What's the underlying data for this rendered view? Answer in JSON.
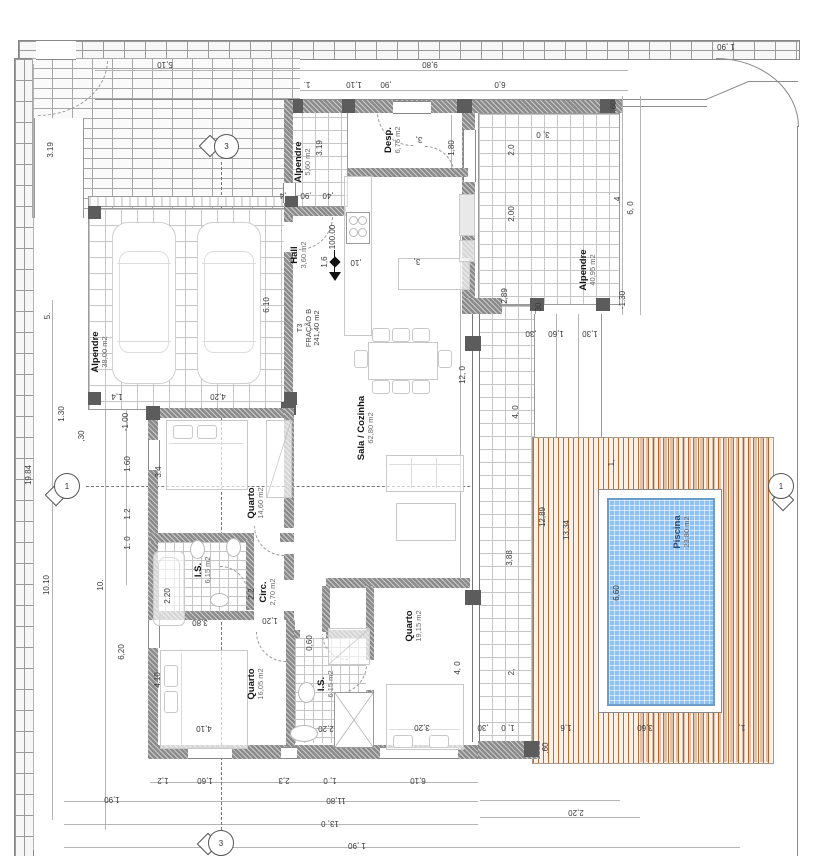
{
  "document": {
    "type": "architectural-floor-plan",
    "language": "pt"
  },
  "unit": {
    "l1": "T3",
    "l2": "FRAÇÃO B",
    "area": "241,40 m2"
  },
  "rooms": [
    {
      "name": "Alpendre",
      "area": "38,00 m2"
    },
    {
      "name": "Alpendre",
      "area": "5,60 m2"
    },
    {
      "name": "Hall",
      "area": "3,60 m2"
    },
    {
      "name": "Desp.",
      "area": "6,75 m2"
    },
    {
      "name": "Sala / Cozinha",
      "area": "62,80 m2"
    },
    {
      "name": "Quarto",
      "area": "14,60 m2"
    },
    {
      "name": "I.S.",
      "area": "6,15 m2"
    },
    {
      "name": "Circ.",
      "area": "2,70 m2"
    },
    {
      "name": "Quarto",
      "area": "16,05 m2"
    },
    {
      "name": "I.S.",
      "area": "6,15 m2"
    },
    {
      "name": "Quarto",
      "area": "19,15 m2"
    },
    {
      "name": "Alpendre",
      "area": "40,95 m2"
    },
    {
      "name": "Piscina",
      "area": "23,80 m2"
    }
  ],
  "level_marker": "100.00",
  "section_markers": {
    "horizontal": "1",
    "vertical": "3"
  },
  "dims": [
    "5,10",
    "9,80",
    "1.",
    "1,10",
    ",90",
    "6,0",
    "1 ,90",
    "3, 0",
    ".60",
    ".4",
    "6, 0",
    "2,0",
    "2,00",
    "2,89",
    "-1.30",
    ",30",
    "1,60",
    "1,30",
    "12,89",
    "13,34",
    "1,",
    "6,60",
    "3,88",
    "4, 0",
    "2,",
    ",30",
    "1, 0",
    "1,6",
    "3,60",
    "1,",
    ".60",
    "2,20",
    "1,2",
    "1,60",
    "2,3",
    "1, 0",
    "6,10",
    "1,90",
    "11,80",
    "13, 0",
    "1 ,90",
    "19.84",
    "10.10",
    "10.",
    "5.",
    "3.19",
    "3.19",
    "6.10",
    "1.30",
    ",30",
    "1,4",
    "4,20",
    "-1.00",
    "1.60",
    "1.2",
    "1. 0",
    "3.4",
    "2.20",
    "6,20",
    "4.10",
    "3,80",
    "1,20",
    "2,20",
    "4,10",
    "3,20",
    "12, 0",
    "2.2",
    "1,6",
    ",10",
    ",4",
    ",90",
    ",40",
    "1,80",
    "3,",
    "3,",
    "0,60",
    "4, 0",
    "30"
  ],
  "colors": {
    "pool_water": "#8fc2f3",
    "pool_edge": "#6d9ecb",
    "deck_wood": "#c06a2d",
    "wall": "#8b8b8b"
  }
}
